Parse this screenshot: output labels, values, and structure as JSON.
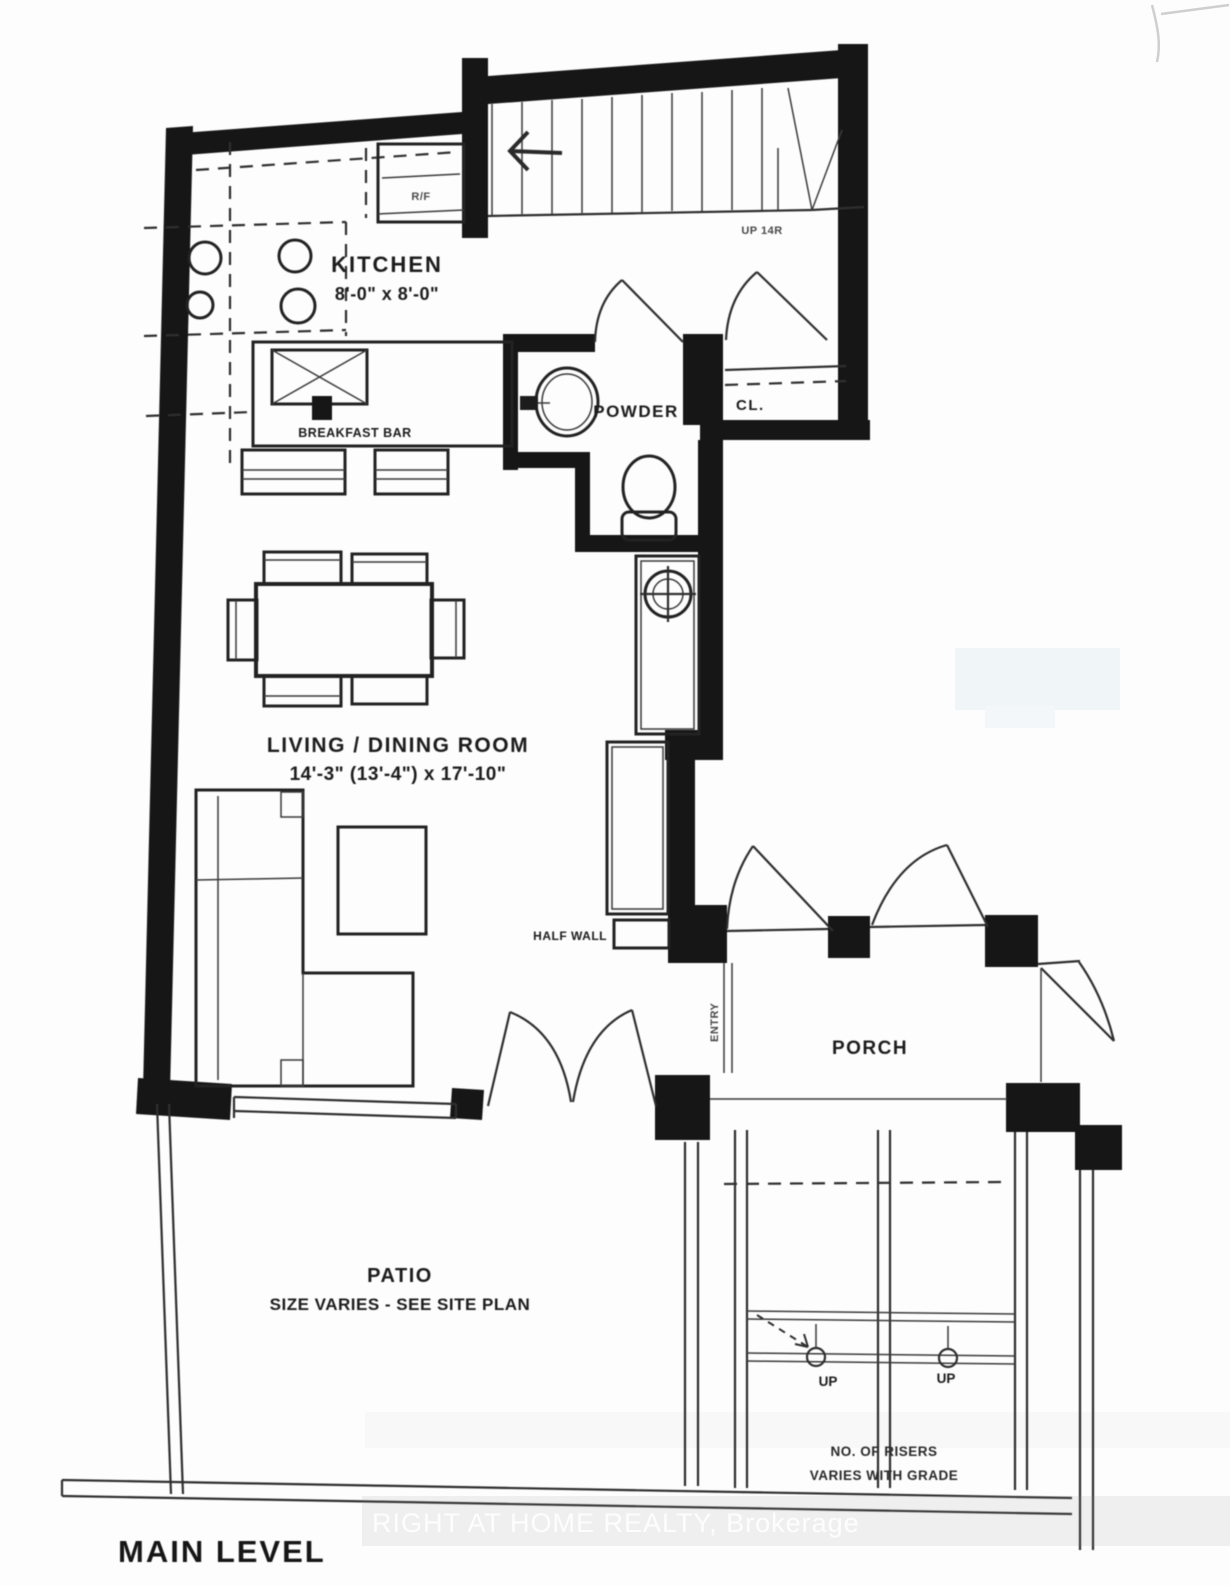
{
  "plan_title": "MAIN LEVEL",
  "watermark": {
    "brand": "RIGHT AT HOME REALTY, Brokerage"
  },
  "rooms": {
    "kitchen": {
      "name": "KITCHEN",
      "dims": "8'-0\" x 8'-0\""
    },
    "living_dining": {
      "name": "LIVING / DINING ROOM",
      "dims": "14'-3\" (13'-4\") x 17'-10\""
    },
    "powder": {
      "name": "POWDER"
    },
    "closet": {
      "name": "CL."
    },
    "porch": {
      "name": "PORCH"
    },
    "entry": {
      "name": "ENTRY"
    },
    "patio": {
      "name": "PATIO",
      "note": "SIZE VARIES - SEE SITE PLAN"
    }
  },
  "labels": {
    "breakfast_bar": "BREAKFAST BAR",
    "fridge": "R/F",
    "stair_direction": "UP 14R",
    "half_wall": "HALF WALL",
    "step_up_left": "UP",
    "step_up_right": "UP",
    "risers_line1": "NO. OF RISERS",
    "risers_line2": "VARIES WITH GRADE"
  },
  "colors": {
    "wall": "#151515",
    "line": "#2e2e2e",
    "watermark_text": "#ffffff"
  }
}
